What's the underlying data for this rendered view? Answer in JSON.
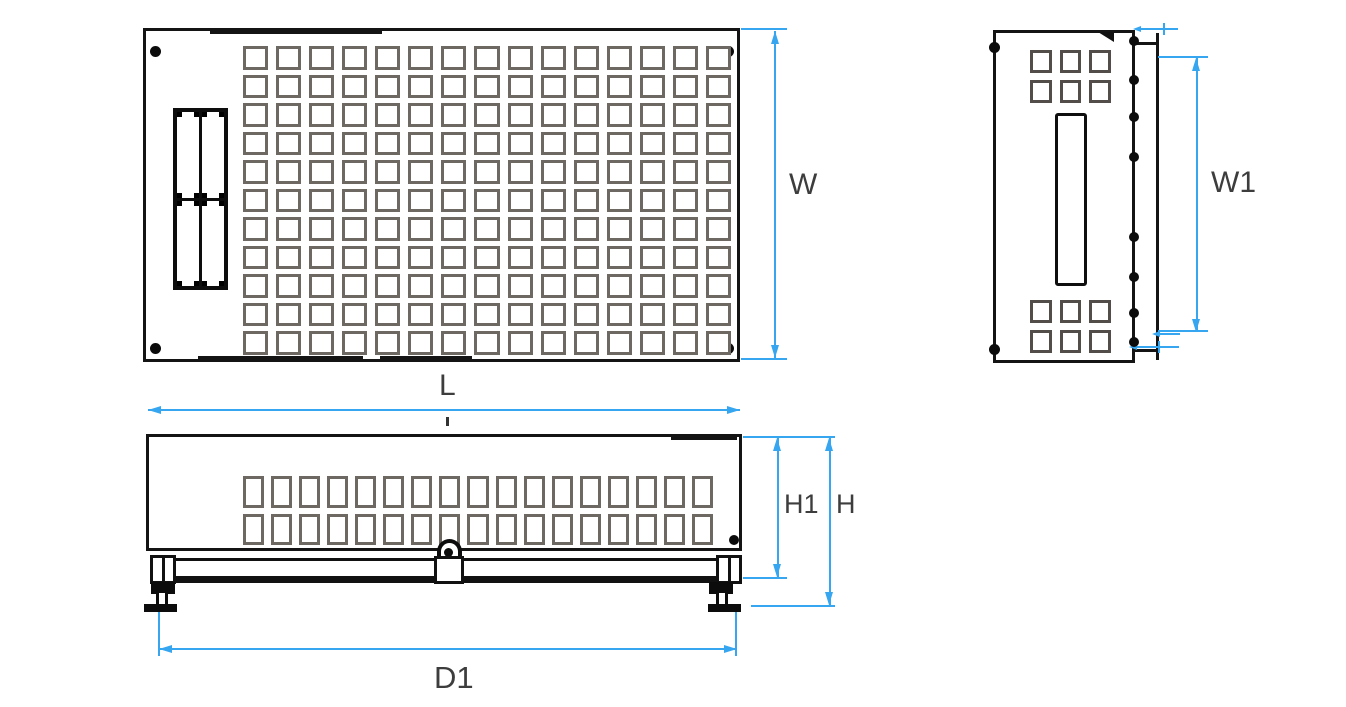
{
  "drawing": {
    "type": "technical-dimension-diagram",
    "labels": {
      "W": "W",
      "W1": "W1",
      "L": "L",
      "H1": "H1",
      "H": "H",
      "D1": "D1"
    },
    "colors": {
      "dimension_line": "#36A6F0",
      "outline": "#141414",
      "vent_outline": "#6E6862",
      "side_vent_outline": "#524D48",
      "label_text": "#3D3D3D",
      "background": "#FFFFFF"
    },
    "views": {
      "top_view": {
        "vent_grid": {
          "columns": 15,
          "rows": 11
        },
        "corner_screws": 4
      },
      "side_view": {
        "vent_grid_top": {
          "columns": 3,
          "rows": 2
        },
        "vent_grid_bottom": {
          "columns": 3,
          "rows": 2
        },
        "edge_bumps": 8
      },
      "front_view": {
        "vent_grid": {
          "columns": 17,
          "rows": 2
        }
      }
    }
  }
}
